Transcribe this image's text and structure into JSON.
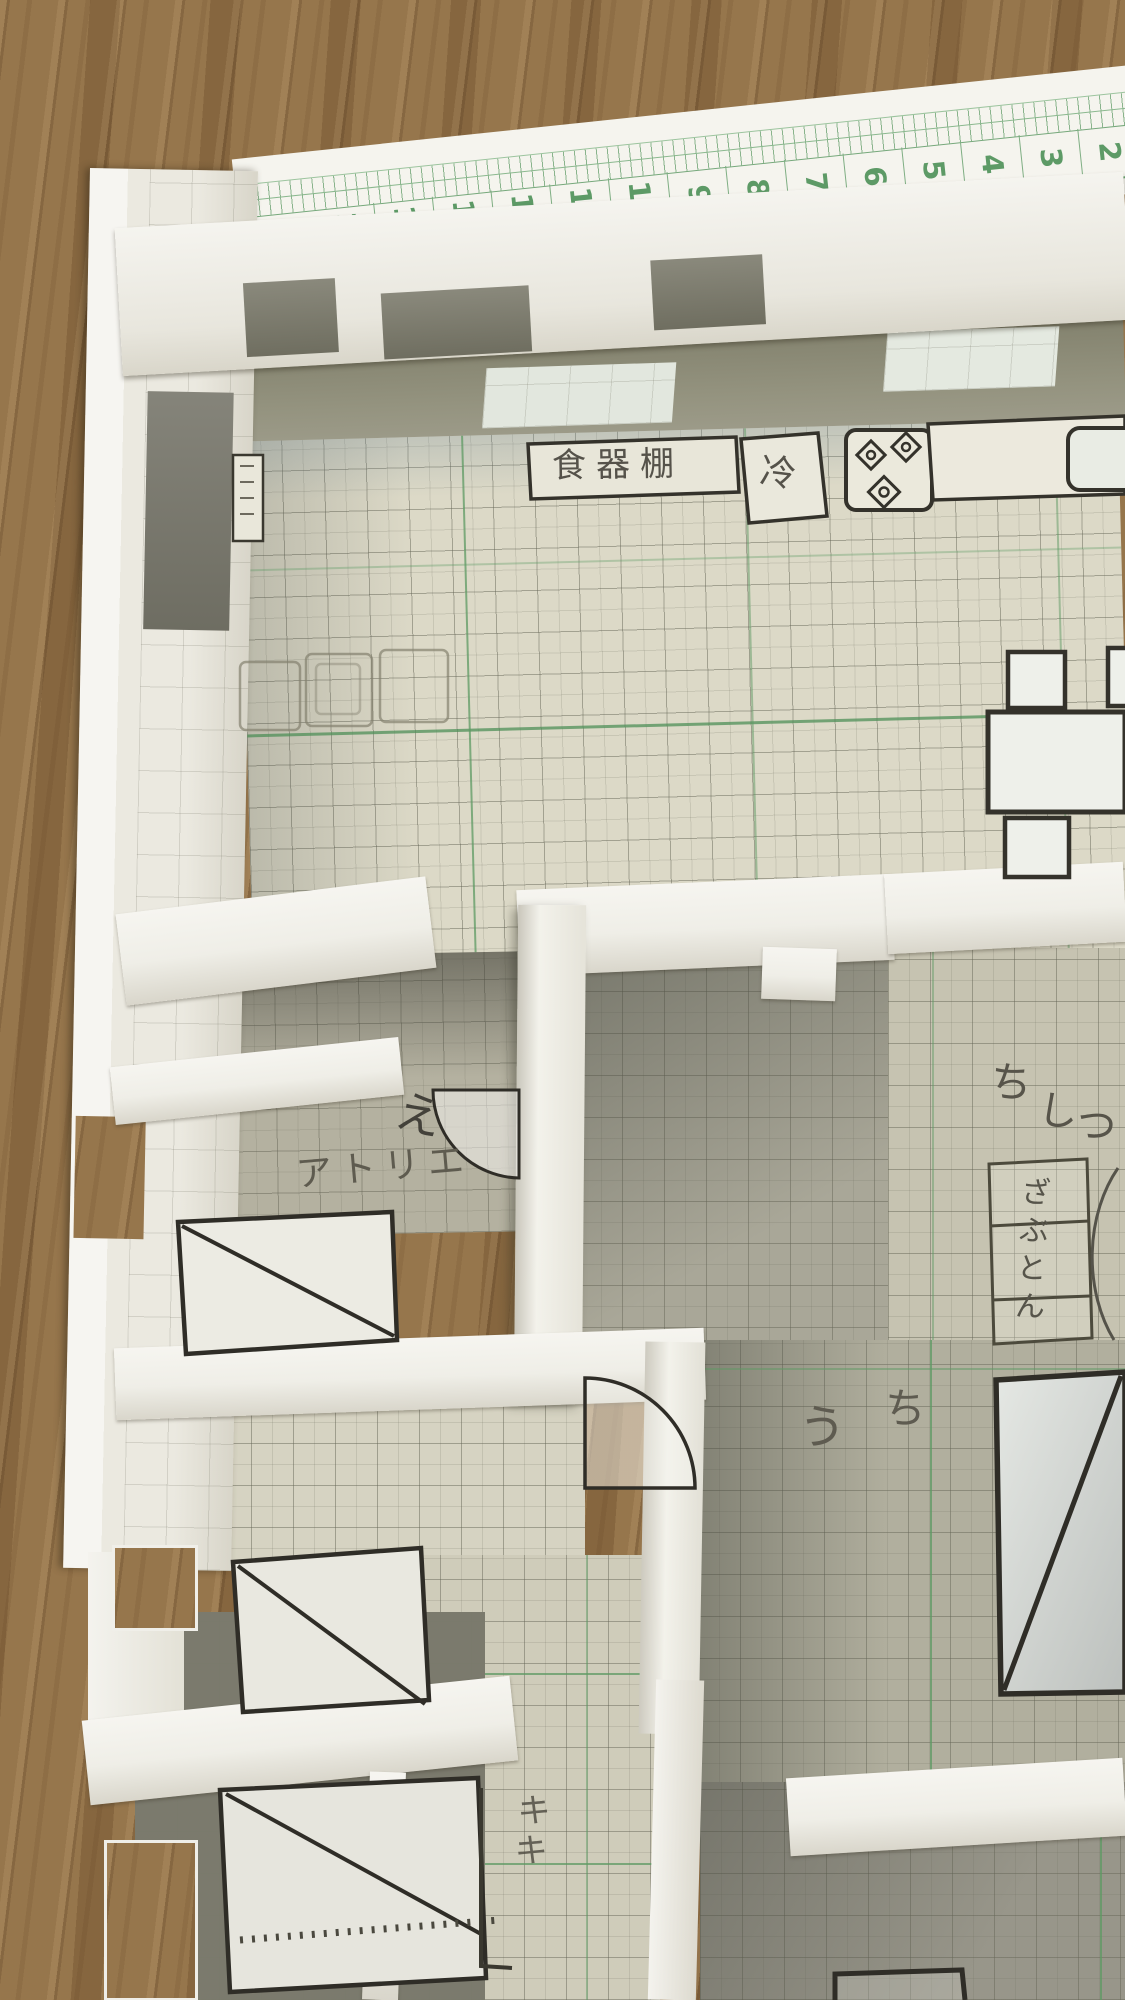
{
  "photo": {
    "subject": "Handmade paper floor-plan model built from green graph paper standing on a wooden table, photographed from above",
    "colors": {
      "wood": "#8e6d44",
      "paper_white": "#f3f2ed",
      "floor_paper": "#dcd9c7",
      "grid_green": "#6fa36f",
      "ruler_green": "#5d9a66",
      "ink": "#34322b",
      "pencil": "#57544a",
      "shadow": "#84836f"
    }
  },
  "ruler": {
    "numbers": [
      "15",
      "14",
      "13",
      "12",
      "11",
      "10",
      "9",
      "8",
      "7",
      "6",
      "5",
      "4",
      "3",
      "2"
    ]
  },
  "kitchen": {
    "cupboard_label": "食器棚",
    "fridge_label": "冷"
  },
  "rooms": {
    "atelier": {
      "label": "アトリエ",
      "pencil_note": "え"
    },
    "tatami": {
      "name_chars": [
        "ち",
        "し",
        "つ"
      ],
      "cushion_box_label": "ざぶとん"
    },
    "hall": {
      "pencil_chars": [
        "う",
        "ち"
      ]
    },
    "bottom": {
      "pencil_marks": "キキ"
    }
  }
}
